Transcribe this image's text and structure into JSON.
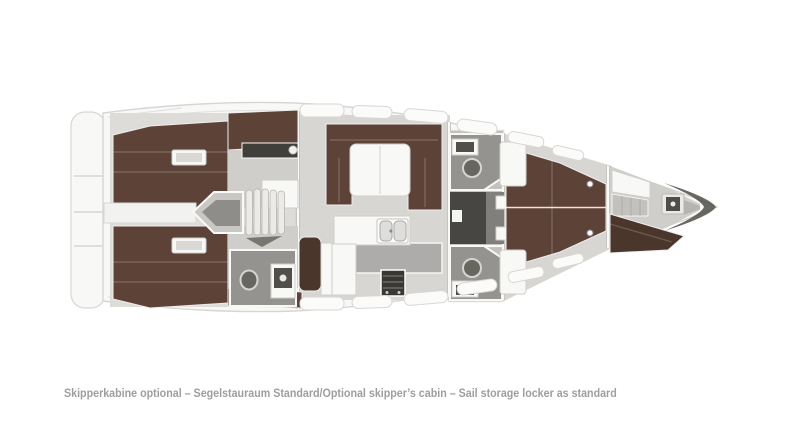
{
  "caption": {
    "text": "Skipperkabine optional – Segelstauraum Standard/Optional skipper’s cabin – Sail storage locker as standard"
  },
  "colors": {
    "page-bg": "#ffffff",
    "hull-fill": "#f8f8f6",
    "hull-line": "#d6d6d4",
    "deck-line": "#e2e2e0",
    "floor": "#d7d6d2",
    "head-floor": "#94938f",
    "berth-brown": "#5d4238",
    "berth-brown-dark": "#4b362c",
    "corridor-dark": "#474642",
    "furniture-white": "#f8f8f6",
    "stove-dark": "#3a3833",
    "bow-shadow": "#4f4e49",
    "caption-gray": "#9e9e9e"
  }
}
